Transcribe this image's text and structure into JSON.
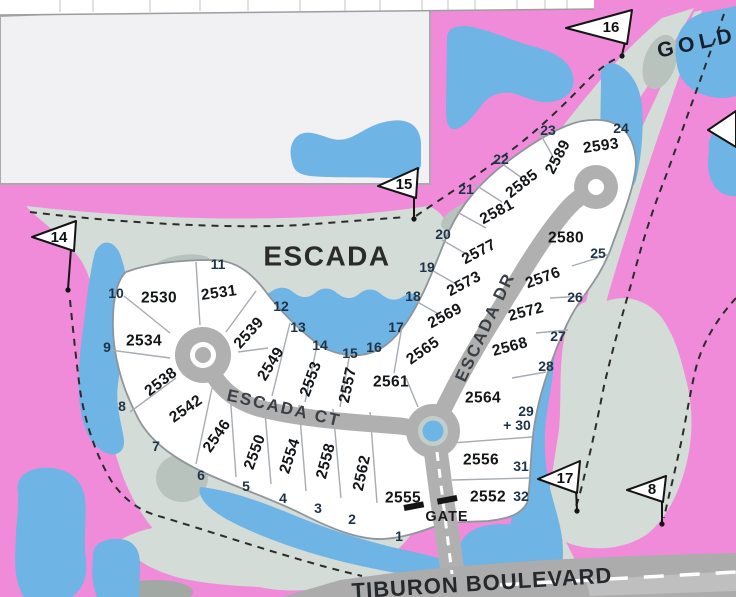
{
  "labels": {
    "community": "ESCADA",
    "street_ct": "ESCADA CT",
    "street_dr": "ESCADA DR",
    "boulevard": "TIBURON BOULEVARD",
    "golf_course": "GOLD",
    "gate": "GATE"
  },
  "lots": [
    "2530",
    "2531",
    "2534",
    "2538",
    "2539",
    "2542",
    "2546",
    "2549",
    "2550",
    "2553",
    "2554",
    "2557",
    "2558",
    "2561",
    "2562",
    "2565",
    "2569",
    "2573",
    "2577",
    "2581",
    "2585",
    "2589",
    "2593",
    "2580",
    "2576",
    "2572",
    "2568",
    "2564",
    "2556",
    "2552",
    "2555"
  ],
  "golf_holes": [
    "14",
    "15",
    "16",
    "17",
    "8"
  ],
  "view_markers": [
    "1",
    "2",
    "3",
    "4",
    "5",
    "6",
    "7",
    "8",
    "9",
    "10",
    "11",
    "12",
    "13",
    "14",
    "15",
    "16",
    "17",
    "18",
    "19",
    "20",
    "21",
    "22",
    "23",
    "24",
    "25",
    "26",
    "27",
    "28",
    "29",
    "+ 30",
    "31",
    "32"
  ],
  "colors": {
    "background_pink": "#F08BDA",
    "fairway": "#D4DCD7",
    "fairway_dark": "#B9C3BD",
    "water": "#6EB4E4",
    "road": "#B0B0B0",
    "lot_fill": "#FFFFFF"
  }
}
